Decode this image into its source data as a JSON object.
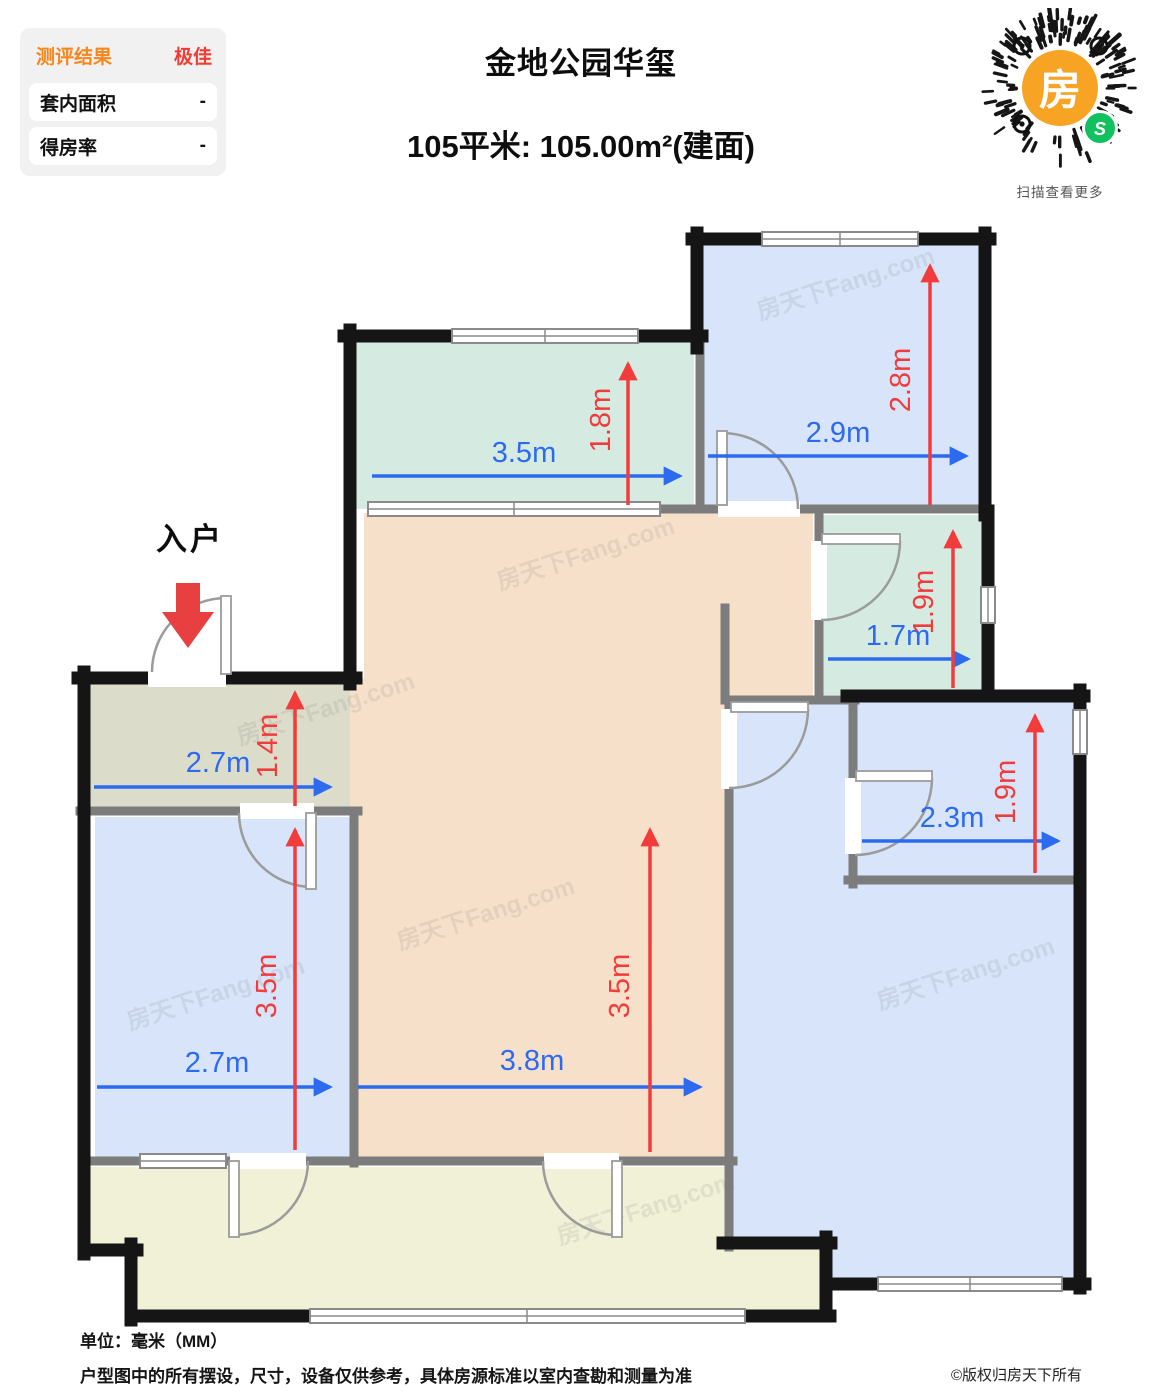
{
  "panel": {
    "title": "测评结果",
    "rating": "极佳",
    "rows": [
      {
        "label": "套内面积",
        "value": "-"
      },
      {
        "label": "得房率",
        "value": "-"
      }
    ]
  },
  "header": {
    "title": "金地公园华玺",
    "subtitle": "105平米: 105.00m²(建面)"
  },
  "qr": {
    "center_glyph": "房",
    "badge_glyph": "S",
    "caption": "扫描查看更多",
    "accent_orange": "#f7a424",
    "badge_green": "#11c05f"
  },
  "plan": {
    "entrance_label": "入户",
    "watermark": "房天下Fang.com",
    "colors": {
      "teal_room": "#d5ebe2",
      "blue_room": "#d7e4fa",
      "tan_room": "#f6e0c9",
      "olive_hall": "#dcdcca",
      "cream_balcony": "#f1f1d8",
      "outer_wall": "#151515",
      "inner_wall": "#7c7c7c",
      "dim_blue": "#2c6af0",
      "dim_red": "#f23c3c"
    },
    "dims": {
      "north_balcony": {
        "w": "3.5m",
        "h": "1.8m"
      },
      "bedroom_ne": {
        "w": "2.9m",
        "h": "2.8m"
      },
      "bathroom": {
        "w": "1.7m",
        "h": "1.9m"
      },
      "utility": {
        "w": "2.3m",
        "h": "1.9m"
      },
      "hall": {
        "w": "2.7m",
        "h": "1.4m"
      },
      "bedroom_w": {
        "w": "2.7m",
        "h": "3.5m"
      },
      "living": {
        "w": "3.8m",
        "h": "3.5m"
      }
    }
  },
  "footer": {
    "unit": "单位：毫米（MM）",
    "disclaimer": "户型图中的所有摆设，尺寸，设备仅供参考，具体房源标准以室内查勘和测量为准",
    "copyright": "©版权归房天下所有"
  }
}
